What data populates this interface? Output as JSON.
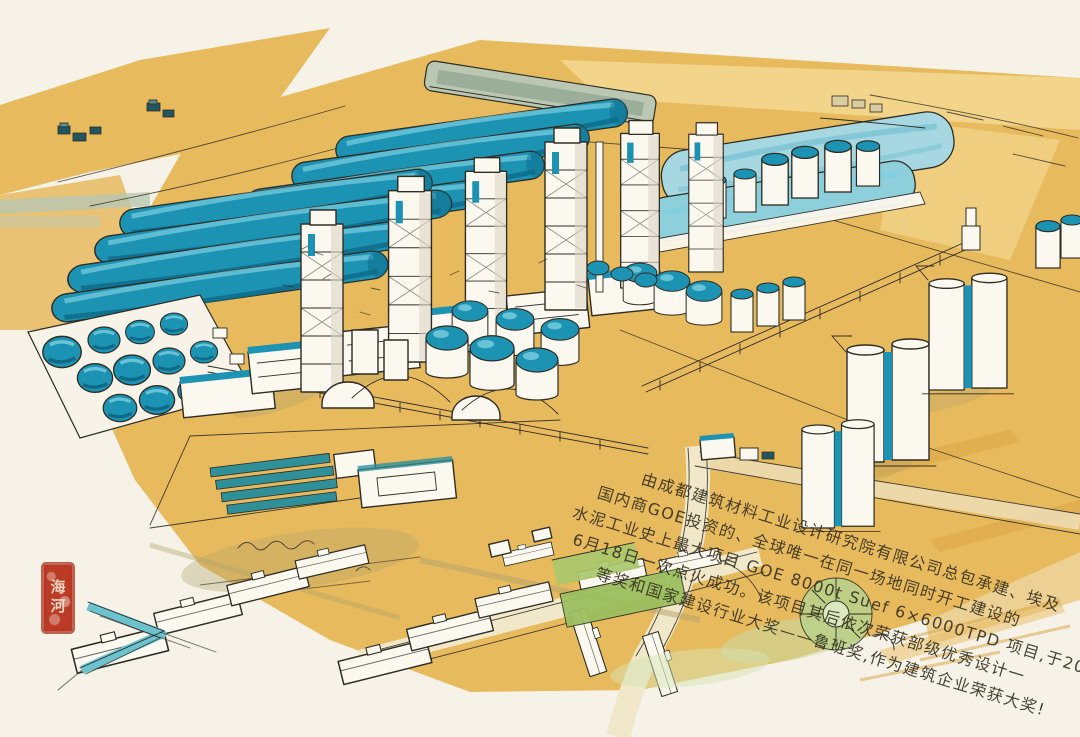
{
  "colors": {
    "paper": "#f6f2e7",
    "ochre": "#e8ba5e",
    "ochre_light": "#f3d78f",
    "ochre_deep": "#d8a140",
    "teal": "#1d93b4",
    "teal_dark": "#0e6a87",
    "teal_light": "#7ccfdf",
    "pale_blue": "#a7d8e2",
    "sage": "#b9c7b3",
    "green": "#a9c86b",
    "green_light": "#c9dba2",
    "ink": "#2e2c23",
    "olive": "#b0a36a",
    "seal_red": "#bc3b27",
    "white_b": "#fbf8ef",
    "shadow": "#ddd6c4"
  },
  "painting": {
    "inscription": {
      "lines": [
        "由成都建筑材料工业设计研究院有限公司总包承建、埃及",
        "国内商GOE投资的、全球唯一在同一场地同时开工建设的",
        "水泥工业史上最大项目 GOE 8000t Suef 6×6000TPD 项目,于2017年",
        "6月18日一次点火成功。该项目其后依次荣获部级优秀设计一",
        "等奖和国家建设行业大奖——鲁班奖,作为建筑企业荣获大奖!"
      ]
    },
    "seal": {
      "text": "海河"
    }
  }
}
